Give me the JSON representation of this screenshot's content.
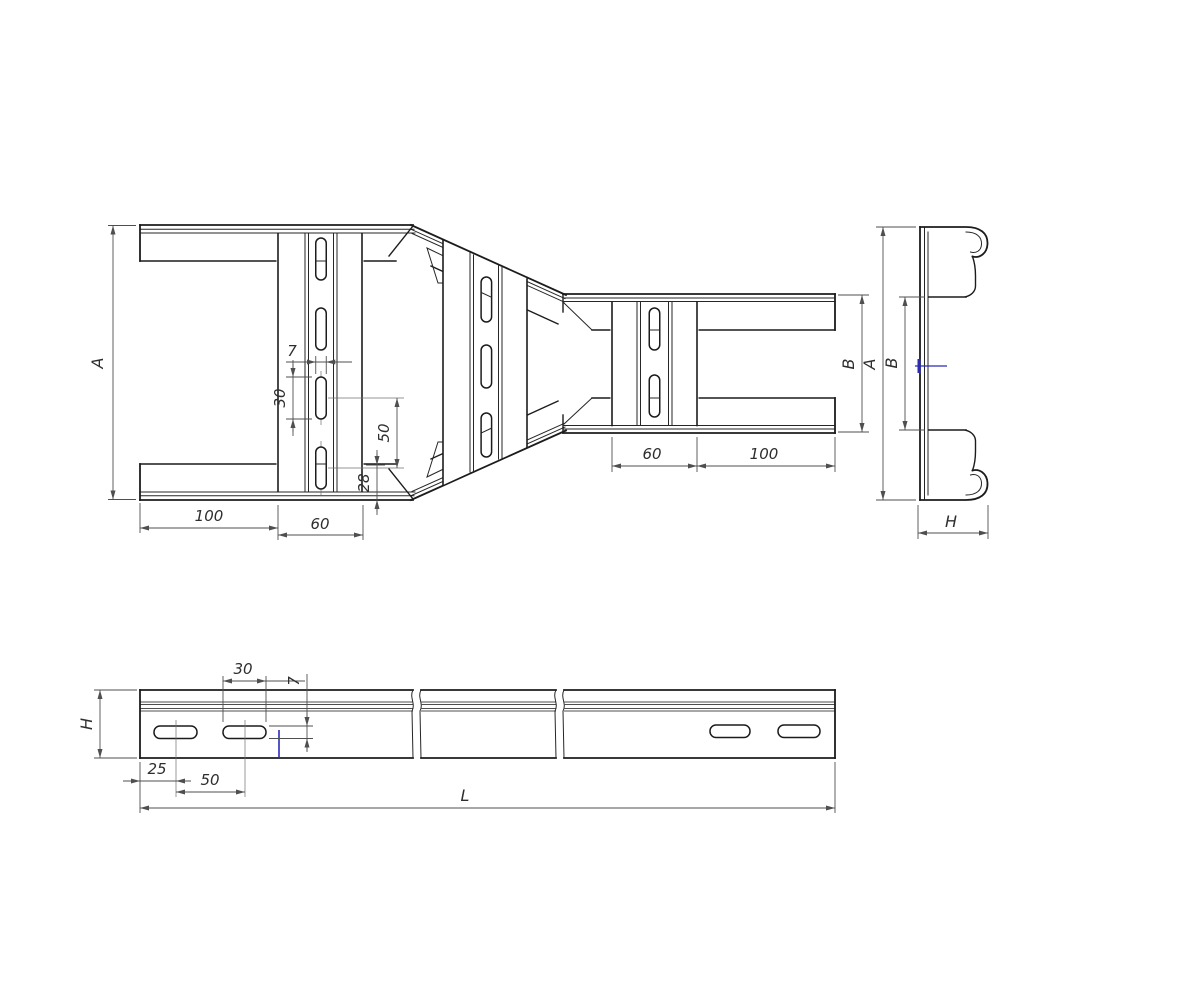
{
  "drawing": {
    "type": "engineering-orthographic-drawing",
    "colors": {
      "line": "#1c1c1c",
      "dimension": "#4f4f4f",
      "accent_blue": "#2a2ab8",
      "background": "#ffffff"
    },
    "labels": {
      "top": {
        "a": "A",
        "left_100": "100",
        "left_60": "60",
        "slot_w_7": "7",
        "slot_len_30": "30",
        "pitch_50": "50",
        "offset_28": "28",
        "right_60": "60",
        "right_100": "100",
        "b": "B"
      },
      "end": {
        "a": "A",
        "b": "B",
        "h": "H"
      },
      "side": {
        "slot_len_30": "30",
        "slot_w_7": "7",
        "h": "H",
        "offset_25": "25",
        "pitch_50": "50",
        "length_l": "L"
      }
    }
  }
}
